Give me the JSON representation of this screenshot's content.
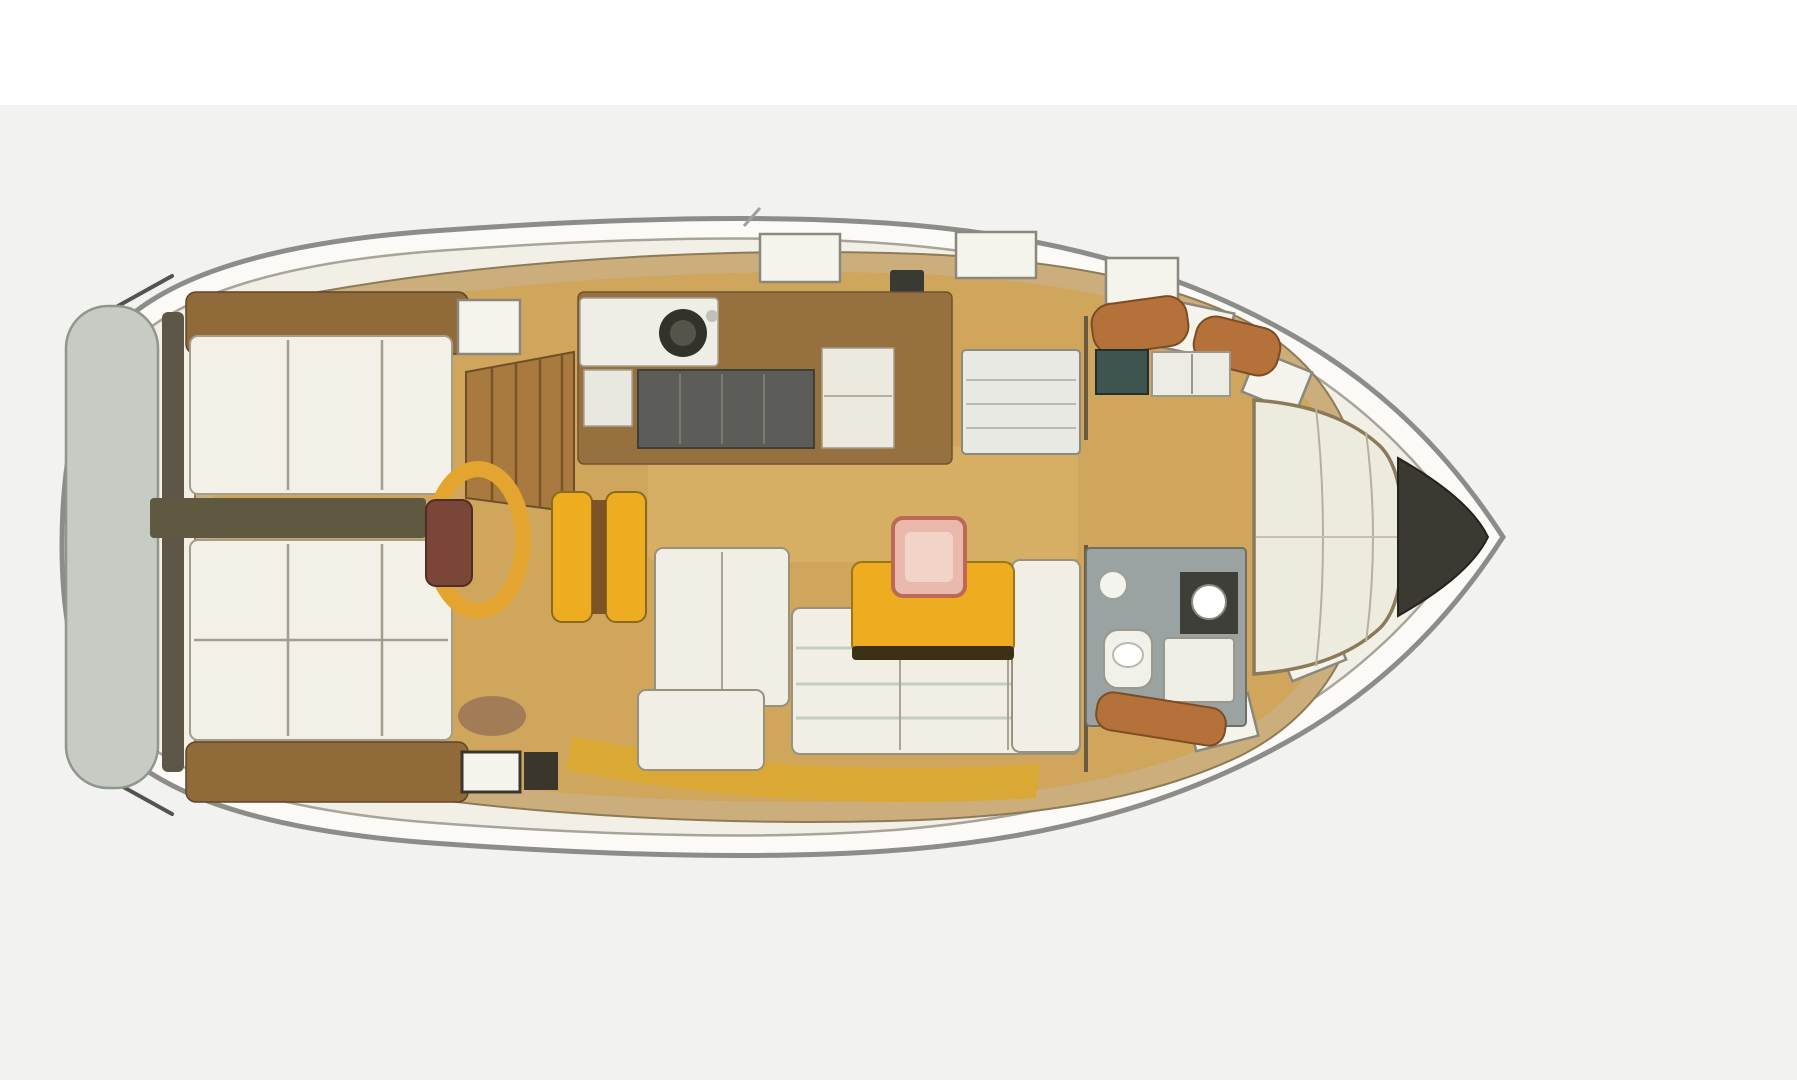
{
  "meta": {
    "type": "boat-floor-plan",
    "subtype": "sailboat-interior-deck-plan",
    "orientation": "bow-right",
    "text_labels": []
  },
  "regions": [
    {
      "id": "swim-platform"
    },
    {
      "id": "cockpit-benches"
    },
    {
      "id": "cockpit-walkway"
    },
    {
      "id": "steering-wheel"
    },
    {
      "id": "helm-pedestal"
    },
    {
      "id": "cockpit-table"
    },
    {
      "id": "companionway-steps"
    },
    {
      "id": "galley"
    },
    {
      "id": "nav-chart-table"
    },
    {
      "id": "salon-settees"
    },
    {
      "id": "salon-table"
    },
    {
      "id": "head-compartment"
    },
    {
      "id": "forward-cabin"
    },
    {
      "id": "v-berth"
    },
    {
      "id": "anchor-locker"
    },
    {
      "id": "side-decks"
    }
  ],
  "colors": {
    "canvas_top": "#ffffff",
    "background": "#f2f2f0",
    "hull_fill": "#fbfaf6",
    "hull_stroke": "#8c8c88",
    "deck_fill": "#f1efe6",
    "deck_stroke": "#a9a49a",
    "coachroof_fill": "#cbae7c",
    "coachroof_stroke": "#8d7b57",
    "cabin_sole": "#cfa65c",
    "sole_light": "#ddb76e",
    "platform_fill": "#c6ccc4",
    "platform_stroke": "#8f968e",
    "transom_dark": "#5e5747",
    "coaming_brown": "#916a3a",
    "cushion_white": "#f2f0e7",
    "cushion_stroke": "#a29e8c",
    "walkway_dark": "#5f5941",
    "wheel_yellow": "#e3a52f",
    "pedestal_brown": "#7b463a",
    "steps_wood": "#a97a3f",
    "galley_wood": "#96713f",
    "counter_dark": "#5c5c58",
    "counter_white": "#eceadf",
    "sink_dark": "#34312b",
    "chart_white": "#e9e9e3",
    "settee_white": "#f1efe5",
    "stripe_green": "#c2cfbc",
    "table_yellow": "#eead20",
    "table_shadow": "#3d3115",
    "tray_pink": "#e9b9ae",
    "tray_stroke": "#bc6a55",
    "head_floor": "#9aa3a1",
    "fixture_white": "#f1f1ea",
    "console_dark": "#3f3f3a",
    "teal_cabinet": "#3e5450",
    "trim_orange": "#b5713a",
    "berth_white": "#edebdd",
    "berth_stroke": "#8a7a58",
    "locker_dark": "#3a3a33",
    "deck_hatch": "#f4f3ec",
    "hatch_stroke": "#8a887c",
    "side_walkway_yellow": "#d9a931",
    "hardware_dark": "#2c2a26"
  }
}
